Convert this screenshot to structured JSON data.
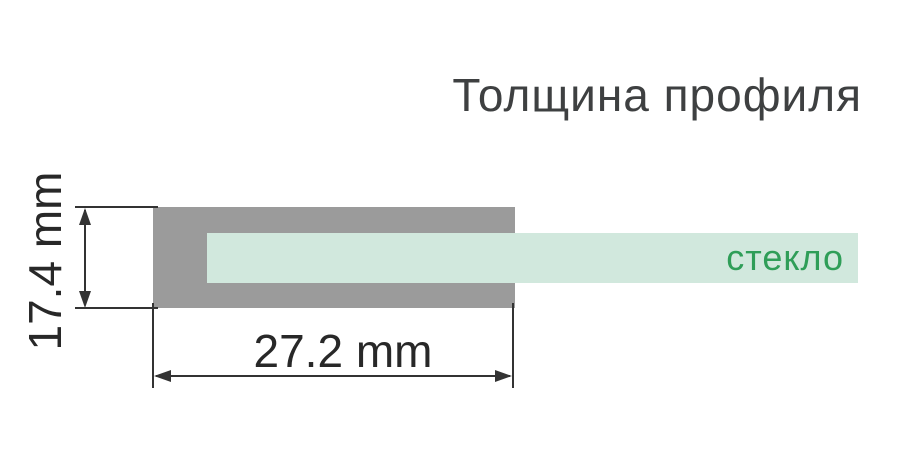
{
  "title": "Толщина профиля",
  "diagram": {
    "glass_label": "стекло",
    "height_dimension": "17.4 mm",
    "width_dimension": "27.2 mm"
  },
  "colors": {
    "background": "#ffffff",
    "profile_gray": "#9b9b9b",
    "glass_mint": "#d1e8dd",
    "glass_label_green": "#2f9e58",
    "title_gray": "#3e4041",
    "dimension_dark": "#333333"
  }
}
